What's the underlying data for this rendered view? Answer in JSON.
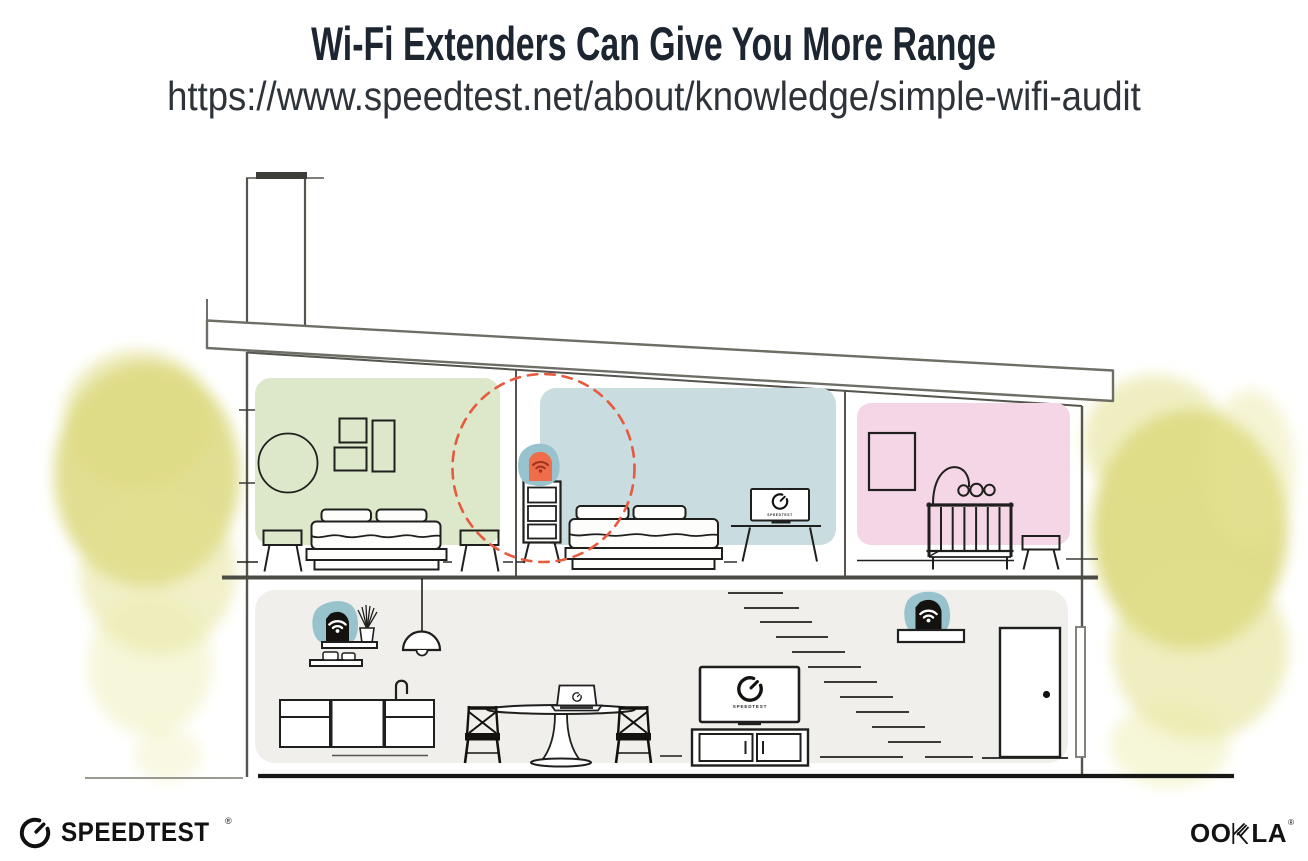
{
  "header": {
    "title": "Wi-Fi Extenders Can Give You More Range",
    "url": "https://www.speedtest.net/about/knowledge/simple-wifi-audit"
  },
  "illustration": {
    "tv_screen_label": "SPEEDTEST"
  },
  "footer": {
    "speedtest_wordmark": "SPEEDTEST",
    "speedtest_reg": "®",
    "ookla_left": "OO",
    "ookla_right": "LA",
    "ookla_reg": "®"
  },
  "colors": {
    "title_ink": "#1c2530",
    "subtitle_ink": "#2d3338",
    "ink": "#1f1f1d",
    "structure_gray": "#55544e",
    "roof_gray": "#6e6e67",
    "room_green": "#dde8cb",
    "room_blue": "#c9dce0",
    "room_pink": "#f4d6e6",
    "floor_gray": "#f0efec",
    "device_teal": "#98c3cd",
    "device_orange": "#ef6d4b",
    "wifi_on_orange": "#a33420",
    "device_black": "#14120f",
    "dashed_red": "#e65a3d",
    "foliage_yellow": "#d9d676"
  }
}
